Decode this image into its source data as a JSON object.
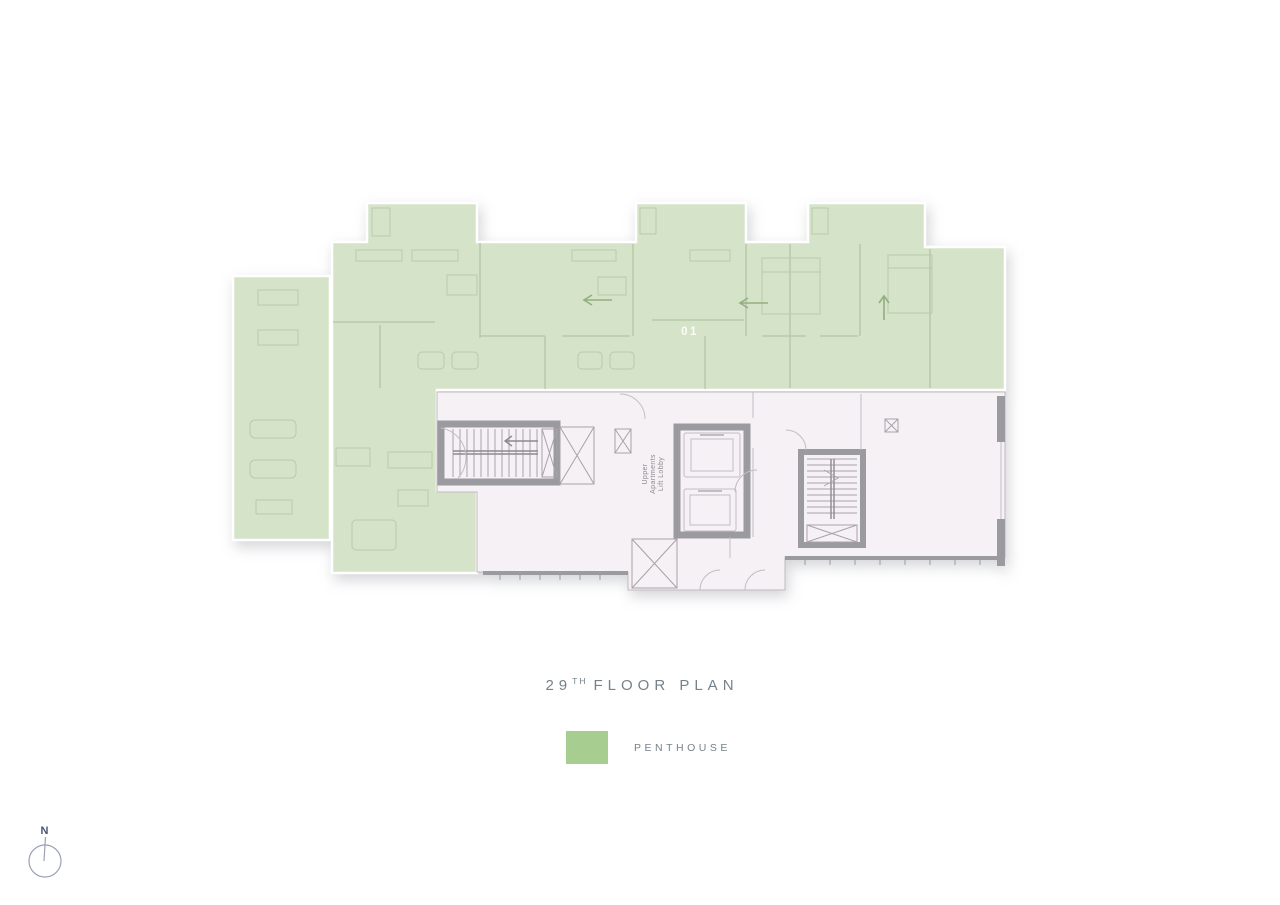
{
  "plan": {
    "unit_label": "01",
    "lobby_label": {
      "line1": "Upper",
      "line2": "Apartments",
      "line3": "Lift Lobby"
    },
    "colors": {
      "penthouse_fill": "#d5e3c8",
      "core_fill": "#f6f1f4",
      "wall_gray": "#9b9b9f"
    }
  },
  "title": {
    "number": "29",
    "ordinal": "TH",
    "text": "FLOOR PLAN"
  },
  "legend": {
    "label": "PENTHOUSE",
    "swatch_color": "#a7cd90"
  },
  "compass": {
    "label": "N"
  }
}
